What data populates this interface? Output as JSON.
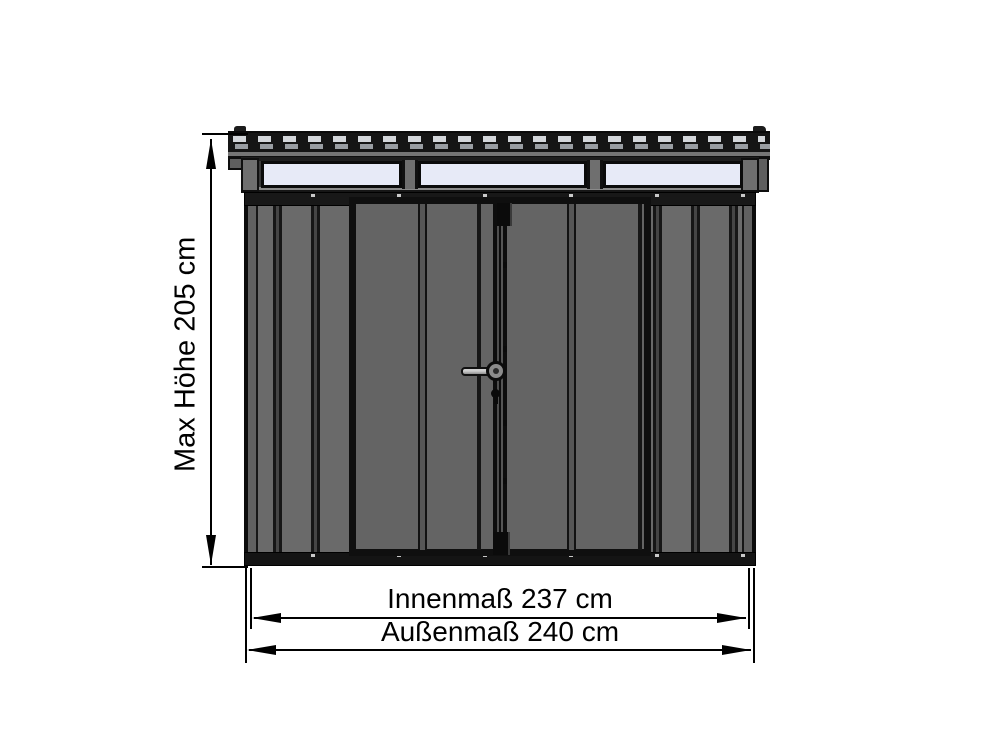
{
  "drawing": {
    "type": "technical-dimension-diagram",
    "subject": "Metal garden shed, front elevation",
    "labels": {
      "max_height": "Max Höhe 205 cm",
      "inner_width": "Innenmaß 237 cm",
      "outer_width": "Außenmaß 240 cm"
    },
    "values": {
      "max_height_cm": 205,
      "inner_width_cm": 237,
      "outer_width_cm": 240
    },
    "features": {
      "skylight_windows": 3,
      "doors": 2,
      "door_hardware": [
        "lever-handle",
        "keyhole"
      ],
      "roof_style": "corrugated flat roof with overhang"
    },
    "colors": {
      "background": "#ffffff",
      "wall_gray": "#6a6a6a",
      "frame_dark": "#111111",
      "skylight_pale": "#e7eaf7",
      "roof_dash_light": "#d3d6da",
      "dimension_line": "#000000"
    }
  }
}
